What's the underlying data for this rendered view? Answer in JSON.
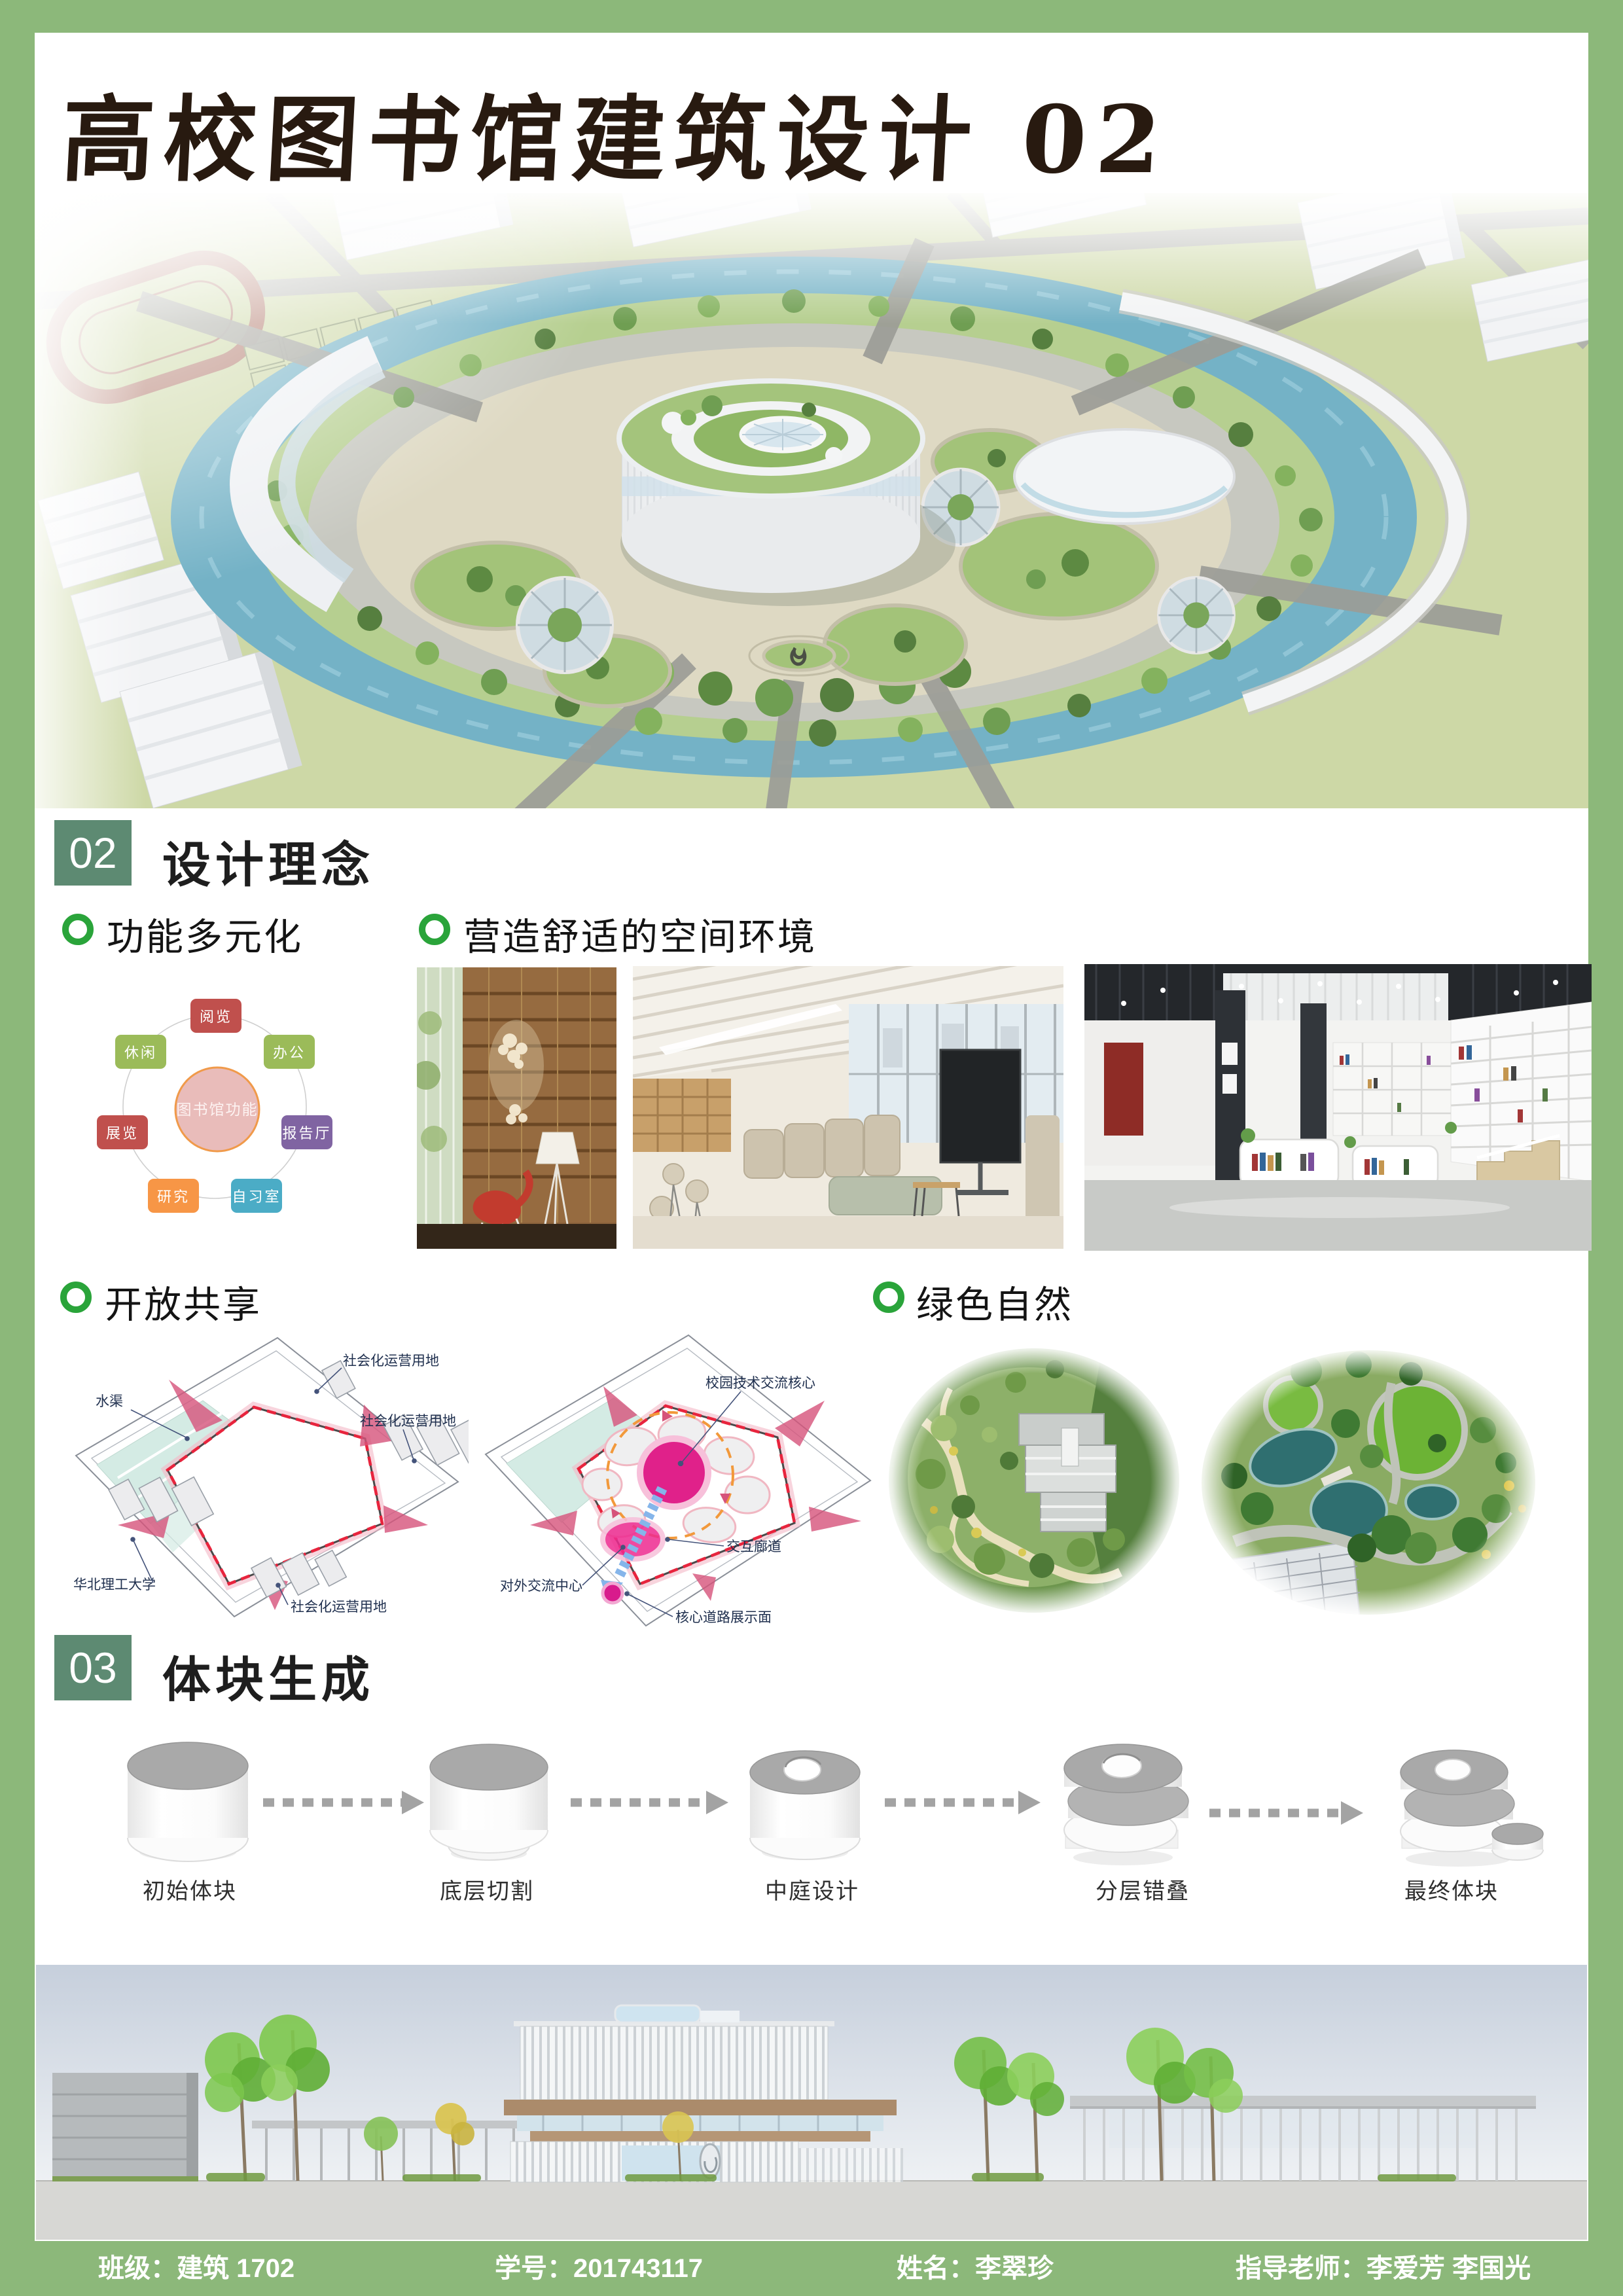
{
  "title": "高校图书馆建筑设计 02",
  "section_concept": {
    "num": "02",
    "title": "设计理念"
  },
  "section_mass": {
    "num": "03",
    "title": "体块生成"
  },
  "bullets": {
    "multi_function": "功能多元化",
    "comfort_space": "营造舒适的空间环境",
    "open_share": "开放共享",
    "green_nature": "绿色自然"
  },
  "function_diagram": {
    "center": "图书馆功能",
    "n_reading": "阅览",
    "n_office": "办公",
    "n_hall": "报告厅",
    "n_study": "自习室",
    "n_research": "研究",
    "n_exhibit": "展览",
    "n_leisure": "休闲"
  },
  "diagram_open": {
    "water": "水渠",
    "social_top": "社会化运营用地",
    "social_right": "社会化运营用地",
    "social_bottom": "社会化运营用地",
    "university": "华北理工大学"
  },
  "diagram_core": {
    "tech_core": "校园技术交流核心",
    "corridor": "交互廊道",
    "exchange_center": "对外交流中心",
    "road_face": "核心道路展示面"
  },
  "mass_steps": {
    "s1": "初始体块",
    "s2": "底层切割",
    "s3": "中庭设计",
    "s4": "分层错叠",
    "s5": "最终体块"
  },
  "footer": {
    "class_label": "班级：",
    "class_value": "建筑 1702",
    "id_label": "学号：",
    "id_value": "201743117",
    "name_label": "姓名：",
    "name_value": "李翠珍",
    "advisor_label": "指导老师：",
    "advisor_value": "李爱芳 李国光"
  },
  "colors": {
    "frame_green": "#8cb87a",
    "badge_green": "#5d8a72",
    "bullet_green": "#2aa43a",
    "title_ink": "#281a10",
    "footer_text": "#ffffff",
    "smartart_red": "#c0504d",
    "smartart_green": "#9bbb59",
    "smartart_purple": "#8064a2",
    "smartart_teal": "#4bacc6",
    "smartart_orange": "#f79646",
    "smartart_center_pink": "#e9bcba",
    "site_red_dash": "#e8243d",
    "site_pink": "#d6537a",
    "core_magenta": "#e0218a",
    "aerial_water": "#74b2c6",
    "aerial_lawn": "#cdd8a6"
  }
}
